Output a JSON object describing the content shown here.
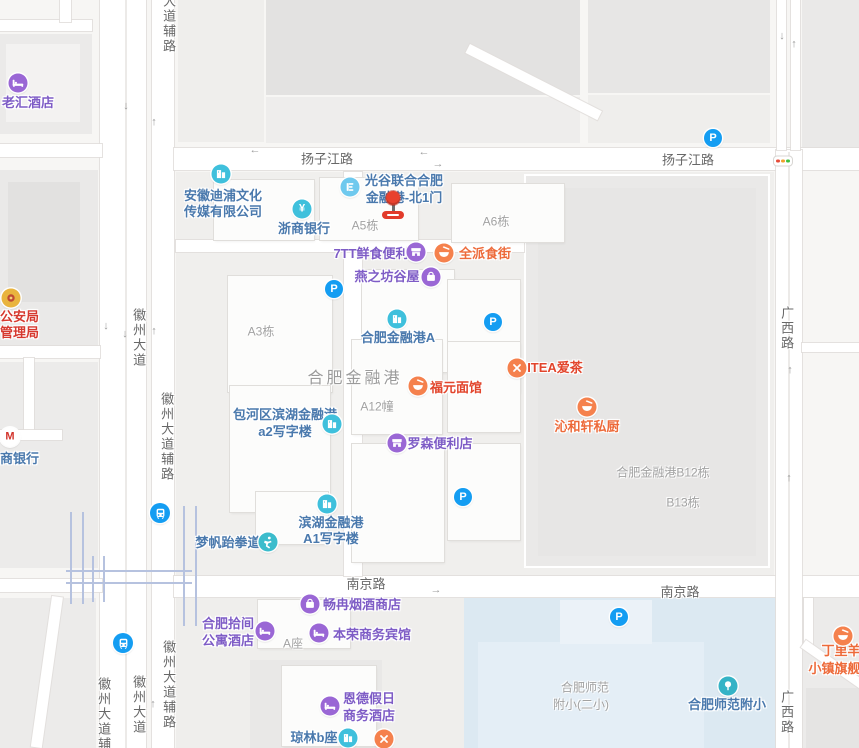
{
  "canvas": {
    "w": 859,
    "h": 748
  },
  "colors": {
    "blue_poi": "#4a79ad",
    "purple_poi": "#7e5cc6",
    "food_poi": "#ed6a3a",
    "red_poi": "#e2452c",
    "police_red": "#d6392f",
    "building_label": "#a2a2a2",
    "road_label": "#686868",
    "parking_blue": "#149df2",
    "icon_purple": "#9a67d5",
    "icon_teal": "#3fc0dc",
    "icon_orange": "#f5814d",
    "school_area": "#dce9f2",
    "marker_red": "#e8412e"
  },
  "road_labels": [
    {
      "name": "yangzijiang-road-west",
      "text": "扬子江路",
      "x": 327,
      "y": 158
    },
    {
      "name": "yangzijiang-road-east",
      "text": "扬子江路",
      "x": 688,
      "y": 159
    },
    {
      "name": "nanjing-road-west",
      "text": "南京路",
      "x": 366,
      "y": 583
    },
    {
      "name": "nanjing-road-east",
      "text": "南京路",
      "x": 680,
      "y": 591
    },
    {
      "name": "huizhou-frontage-top",
      "text": "大道辅路",
      "x": 168,
      "ytop": -6,
      "vertical": true
    },
    {
      "name": "huizhou-avenue-mid",
      "text": "徽州大道",
      "x": 138,
      "ytop": 308,
      "vertical": true
    },
    {
      "name": "huizhou-frontage-mid",
      "text": "徽州大道辅路",
      "x": 166,
      "ytop": 392,
      "vertical": true
    },
    {
      "name": "guangxi-road-north",
      "text": "广西路",
      "x": 786,
      "ytop": 306,
      "vertical": true
    },
    {
      "name": "guangxi-road-south",
      "text": "广西路",
      "x": 786,
      "ytop": 690,
      "vertical": true
    },
    {
      "name": "huizhou-avenue-south",
      "text": "徽州大道",
      "x": 138,
      "ytop": 675,
      "vertical": true
    },
    {
      "name": "huizhou-frontage-sw",
      "text": "徽州大道辅路",
      "x": 103,
      "ytop": 677,
      "vertical": true
    },
    {
      "name": "huizhou-frontage-s",
      "text": "徽州大道辅路",
      "x": 168,
      "ytop": 640,
      "vertical": true
    }
  ],
  "building_labels": [
    {
      "name": "label-a5",
      "text": "A5栋",
      "x": 365,
      "y": 225
    },
    {
      "name": "label-a6",
      "text": "A6栋",
      "x": 496,
      "y": 221
    },
    {
      "name": "label-a3",
      "text": "A3栋",
      "x": 261,
      "y": 331
    },
    {
      "name": "label-a12",
      "text": "A12幢",
      "x": 377,
      "y": 406
    },
    {
      "name": "label-hefei-financial-port",
      "text": "合肥金融港",
      "x": 355,
      "y": 376,
      "big": true
    },
    {
      "name": "label-b12",
      "text": "合肥金融港B12栋",
      "x": 663,
      "y": 472
    },
    {
      "name": "label-b13",
      "text": "B13栋",
      "x": 683,
      "y": 502
    },
    {
      "name": "label-a-zuo",
      "text": "A座",
      "x": 293,
      "y": 643
    },
    {
      "name": "label-school-line1",
      "text": "合肥师范",
      "x": 585,
      "y": 687
    },
    {
      "name": "label-school-line2",
      "text": "附小(二小)",
      "x": 581,
      "y": 704
    }
  ],
  "pois": [
    {
      "name": "poi-laohui-hotel",
      "icon": "hotel",
      "ix": 18,
      "iy": 83,
      "lines": [
        "老汇酒店"
      ],
      "tx": 2,
      "ty": 102,
      "anchor": "left",
      "c": "purple"
    },
    {
      "name": "poi-anhui-dipu-media",
      "icon": "building",
      "ix": 221,
      "iy": 174,
      "lines": [
        "安徽迪浦文化",
        "传媒有限公司"
      ],
      "tx": 223,
      "ty": 196,
      "lh": 16,
      "c": "blue"
    },
    {
      "name": "poi-zheshang-bank",
      "icon": "yuan",
      "ix": 302,
      "iy": 209,
      "lines": [
        "浙商银行"
      ],
      "tx": 304,
      "ty": 228,
      "c": "blue"
    },
    {
      "name": "poi-north-gate-1",
      "icon": "gate",
      "ix": 350,
      "iy": 187,
      "lines": [
        "光谷联合合肥",
        "金融港-北1门"
      ],
      "tx": 404,
      "ty": 180,
      "lh": 17,
      "c": "blue"
    },
    {
      "name": "poi-7tt-store",
      "icon": "shop",
      "ix": 416,
      "iy": 252,
      "lines": [
        "7TT鲜食便利"
      ],
      "tx": 371,
      "ty": 253,
      "c": "purple"
    },
    {
      "name": "poi-quanpai-food-street",
      "icon": "bowl",
      "ix": 444,
      "iy": 253,
      "lines": [
        "全派食街"
      ],
      "tx": 485,
      "ty": 253,
      "c": "food"
    },
    {
      "name": "poi-yanzhifang-guwu",
      "icon": "bag",
      "ix": 431,
      "iy": 277,
      "lines": [
        "燕之坊谷屋"
      ],
      "tx": 387,
      "ty": 276,
      "c": "purple"
    },
    {
      "name": "poi-financial-port-a",
      "icon": "building",
      "ix": 397,
      "iy": 319,
      "lines": [
        "合肥金融港A"
      ],
      "tx": 398,
      "ty": 337,
      "c": "blue"
    },
    {
      "name": "poi-fuyuan-noodle",
      "icon": "bowl",
      "ix": 418,
      "iy": 386,
      "lines": [
        "福元面馆"
      ],
      "tx": 456,
      "ty": 387,
      "c": "red"
    },
    {
      "name": "poi-itea-tea",
      "icon": "cutlery",
      "ix": 517,
      "iy": 368,
      "lines": [
        "ITEA爱茶"
      ],
      "tx": 555,
      "ty": 367,
      "c": "red"
    },
    {
      "name": "poi-qinhexuan-kitchen",
      "icon": "bowl",
      "ix": 587,
      "iy": 407,
      "lines": [
        "沁和轩私厨"
      ],
      "tx": 587,
      "ty": 426,
      "c": "food"
    },
    {
      "name": "poi-baohe-a2-office",
      "icon": "building",
      "ix": 332,
      "iy": 424,
      "lines": [
        "包河区滨湖金融港",
        "a2写字楼"
      ],
      "tx": 285,
      "ty": 414,
      "lh": 17,
      "c": "blue"
    },
    {
      "name": "poi-lawson-store",
      "icon": "shop",
      "ix": 397,
      "iy": 443,
      "lines": [
        "罗森便利店"
      ],
      "tx": 440,
      "ty": 443,
      "c": "purple"
    },
    {
      "name": "poi-mengfan-taekwondo",
      "icon": "taekwondo",
      "ix": 268,
      "iy": 542,
      "lines": [
        "梦帆跆拳道"
      ],
      "tx": 228,
      "ty": 542,
      "c": "blue"
    },
    {
      "name": "poi-binhu-a1-office",
      "icon": "building",
      "ix": 327,
      "iy": 504,
      "lines": [
        "滨湖金融港",
        "A1写字楼"
      ],
      "tx": 331,
      "ty": 523,
      "lh": 16,
      "c": "blue"
    },
    {
      "name": "poi-changran-tobacco",
      "icon": "bag",
      "ix": 310,
      "iy": 604,
      "lines": [
        "畅冉烟酒商店"
      ],
      "tx": 362,
      "ty": 604,
      "c": "purple"
    },
    {
      "name": "poi-shijian-hotel",
      "icon": "hotel",
      "ix": 265,
      "iy": 631,
      "lines": [
        "合肥拾间",
        "公寓酒店"
      ],
      "tx": 228,
      "ty": 623,
      "lh": 17,
      "c": "purple"
    },
    {
      "name": "poi-benrong-hotel",
      "icon": "hotel",
      "ix": 319,
      "iy": 633,
      "lines": [
        "本荣商务宾馆"
      ],
      "tx": 372,
      "ty": 634,
      "c": "purple"
    },
    {
      "name": "poi-ende-holiday-hotel",
      "icon": "hotel",
      "ix": 330,
      "iy": 706,
      "lines": [
        "恩德假日",
        "商务酒店"
      ],
      "tx": 369,
      "ty": 698,
      "lh": 17,
      "c": "purple"
    },
    {
      "name": "poi-qionglin-b-block",
      "icon": "building",
      "ix": 348,
      "iy": 738,
      "lines": [
        "琼林b座"
      ],
      "tx": 314,
      "ty": 737,
      "c": "blue"
    },
    {
      "name": "poi-restaurant-south",
      "icon": "cutlery",
      "ix": 384,
      "iy": 739,
      "lines": []
    },
    {
      "name": "poi-police-bureau",
      "icon": "badge",
      "ix": 11,
      "iy": 298,
      "lines": [
        "公安局",
        "管理局"
      ],
      "tx": 0,
      "ty": 317,
      "lh": 16,
      "anchor": "left",
      "c": "police"
    },
    {
      "name": "poi-cmb-bank",
      "icon": "cmb",
      "ix": 10,
      "iy": 437,
      "lines": [
        "商银行"
      ],
      "tx": 0,
      "ty": 458,
      "anchor": "left",
      "c": "blue"
    },
    {
      "name": "poi-normal-primary-school",
      "icon": "tree",
      "ix": 728,
      "iy": 686,
      "lines": [
        "合肥师范附小"
      ],
      "tx": 727,
      "ty": 704,
      "c": "blue"
    },
    {
      "name": "poi-dingliyang-flagship",
      "icon": "bowl",
      "ix": 843,
      "iy": 636,
      "lines": [
        "丁里羊",
        "小镇旗舰店"
      ],
      "tx": 841,
      "ty": 651,
      "lh": 18,
      "c": "food"
    }
  ],
  "parkings": [
    {
      "x": 713,
      "y": 138
    },
    {
      "x": 334,
      "y": 289
    },
    {
      "x": 493,
      "y": 322
    },
    {
      "x": 463,
      "y": 497
    },
    {
      "x": 619,
      "y": 617
    }
  ],
  "metro_stations": [
    {
      "x": 160,
      "y": 513
    },
    {
      "x": 123,
      "y": 643
    }
  ],
  "arrows": [
    {
      "x": 126,
      "y": 106,
      "g": "↓"
    },
    {
      "x": 154,
      "y": 122,
      "g": "↑"
    },
    {
      "x": 255,
      "y": 150,
      "g": "←"
    },
    {
      "x": 424,
      "y": 152,
      "g": "←"
    },
    {
      "x": 438,
      "y": 164,
      "g": "→"
    },
    {
      "x": 106,
      "y": 326,
      "g": "↓"
    },
    {
      "x": 125,
      "y": 334,
      "g": "↓"
    },
    {
      "x": 154,
      "y": 331,
      "g": "↑"
    },
    {
      "x": 153,
      "y": 704,
      "g": "↑"
    },
    {
      "x": 782,
      "y": 36,
      "g": "↓"
    },
    {
      "x": 794,
      "y": 44,
      "g": "↑"
    },
    {
      "x": 790,
      "y": 370,
      "g": "↑"
    },
    {
      "x": 789,
      "y": 478,
      "g": "↑"
    },
    {
      "x": 436,
      "y": 590,
      "g": "→"
    }
  ],
  "traffic_light": {
    "x": 783,
    "y": 161
  },
  "marker": {
    "x": 393,
    "y": 198
  }
}
